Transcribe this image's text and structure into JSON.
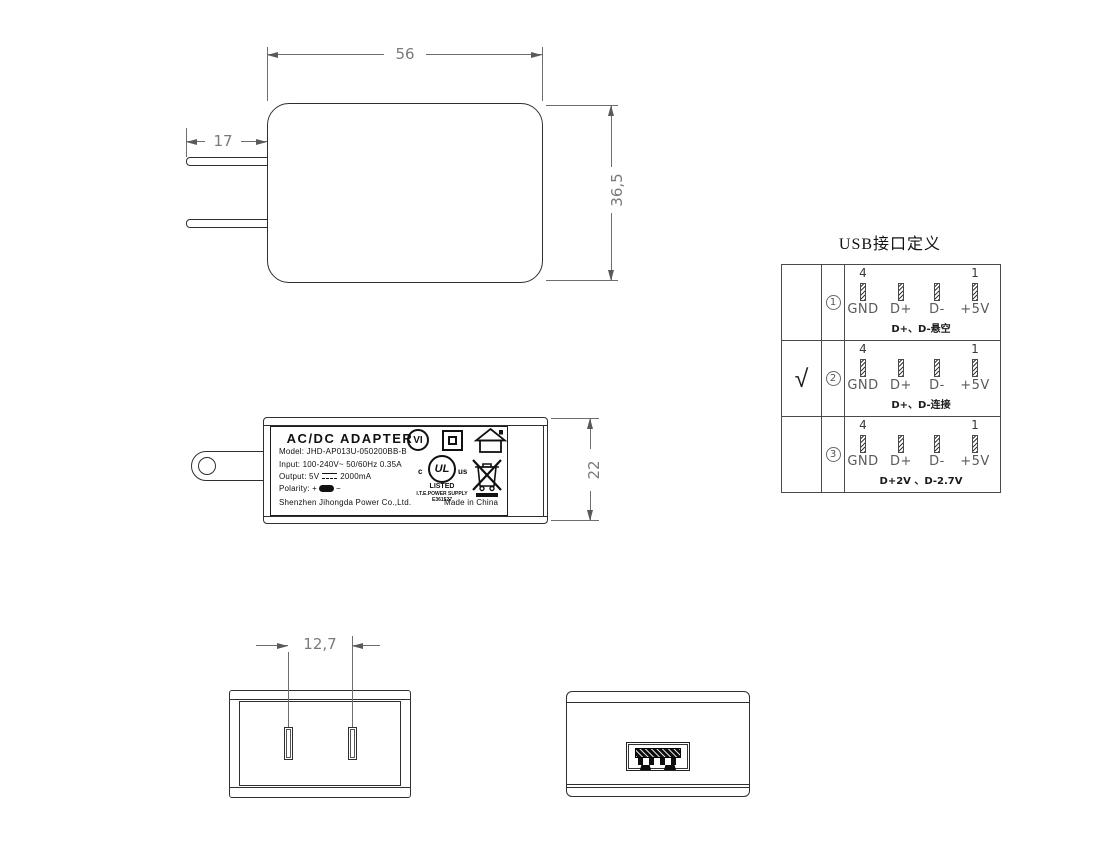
{
  "colors": {
    "object_line": "#2f2f2f",
    "dim_line": "#6e6e6e",
    "dim_text": "#7a7a7a",
    "ink": "#111111"
  },
  "front_view": {
    "width_dim": "56",
    "height_dim": "36,5",
    "prong_dim": "17"
  },
  "side_view": {
    "height_dim": "22",
    "label": {
      "title": "AC/DC ADAPTER",
      "model": "Model: JHD-AP013U-050200BB-B",
      "input": "Input: 100-240V~ 50/60Hz 0.35A",
      "output_prefix": "Output: 5V",
      "output_suffix": "2000mA",
      "polarity_label": "Polarity:",
      "polarity_plus": "+",
      "polarity_minus": "−",
      "company": "Shenzhen Jihongda Power Co.,Ltd.",
      "made_in": "Made in China",
      "efficiency_mark": "VI",
      "ul_c": "c",
      "ul_letters": "UL",
      "ul_us": "us",
      "ul_listed": "LISTED",
      "ul_type": "I.T.E.POWER SUPPLY",
      "ul_file": "E361527"
    }
  },
  "usb_table": {
    "title": "USB接口定义",
    "rows": [
      {
        "selected": "",
        "num": "1",
        "pin_first": "4",
        "pin_last": "1",
        "pins": [
          "GND",
          "D+",
          "D-",
          "+5V"
        ],
        "caption": "D+、D-悬空"
      },
      {
        "selected": "√",
        "num": "2",
        "pin_first": "4",
        "pin_last": "1",
        "pins": [
          "GND",
          "D+",
          "D-",
          "+5V"
        ],
        "caption": "D+、D-连接"
      },
      {
        "selected": "",
        "num": "3",
        "pin_first": "4",
        "pin_last": "1",
        "pins": [
          "GND",
          "D+",
          "D-",
          "+5V"
        ],
        "caption": "D+2V 、D-2.7V"
      }
    ]
  },
  "bottom_view": {
    "pin_spacing_dim": "12,7"
  }
}
